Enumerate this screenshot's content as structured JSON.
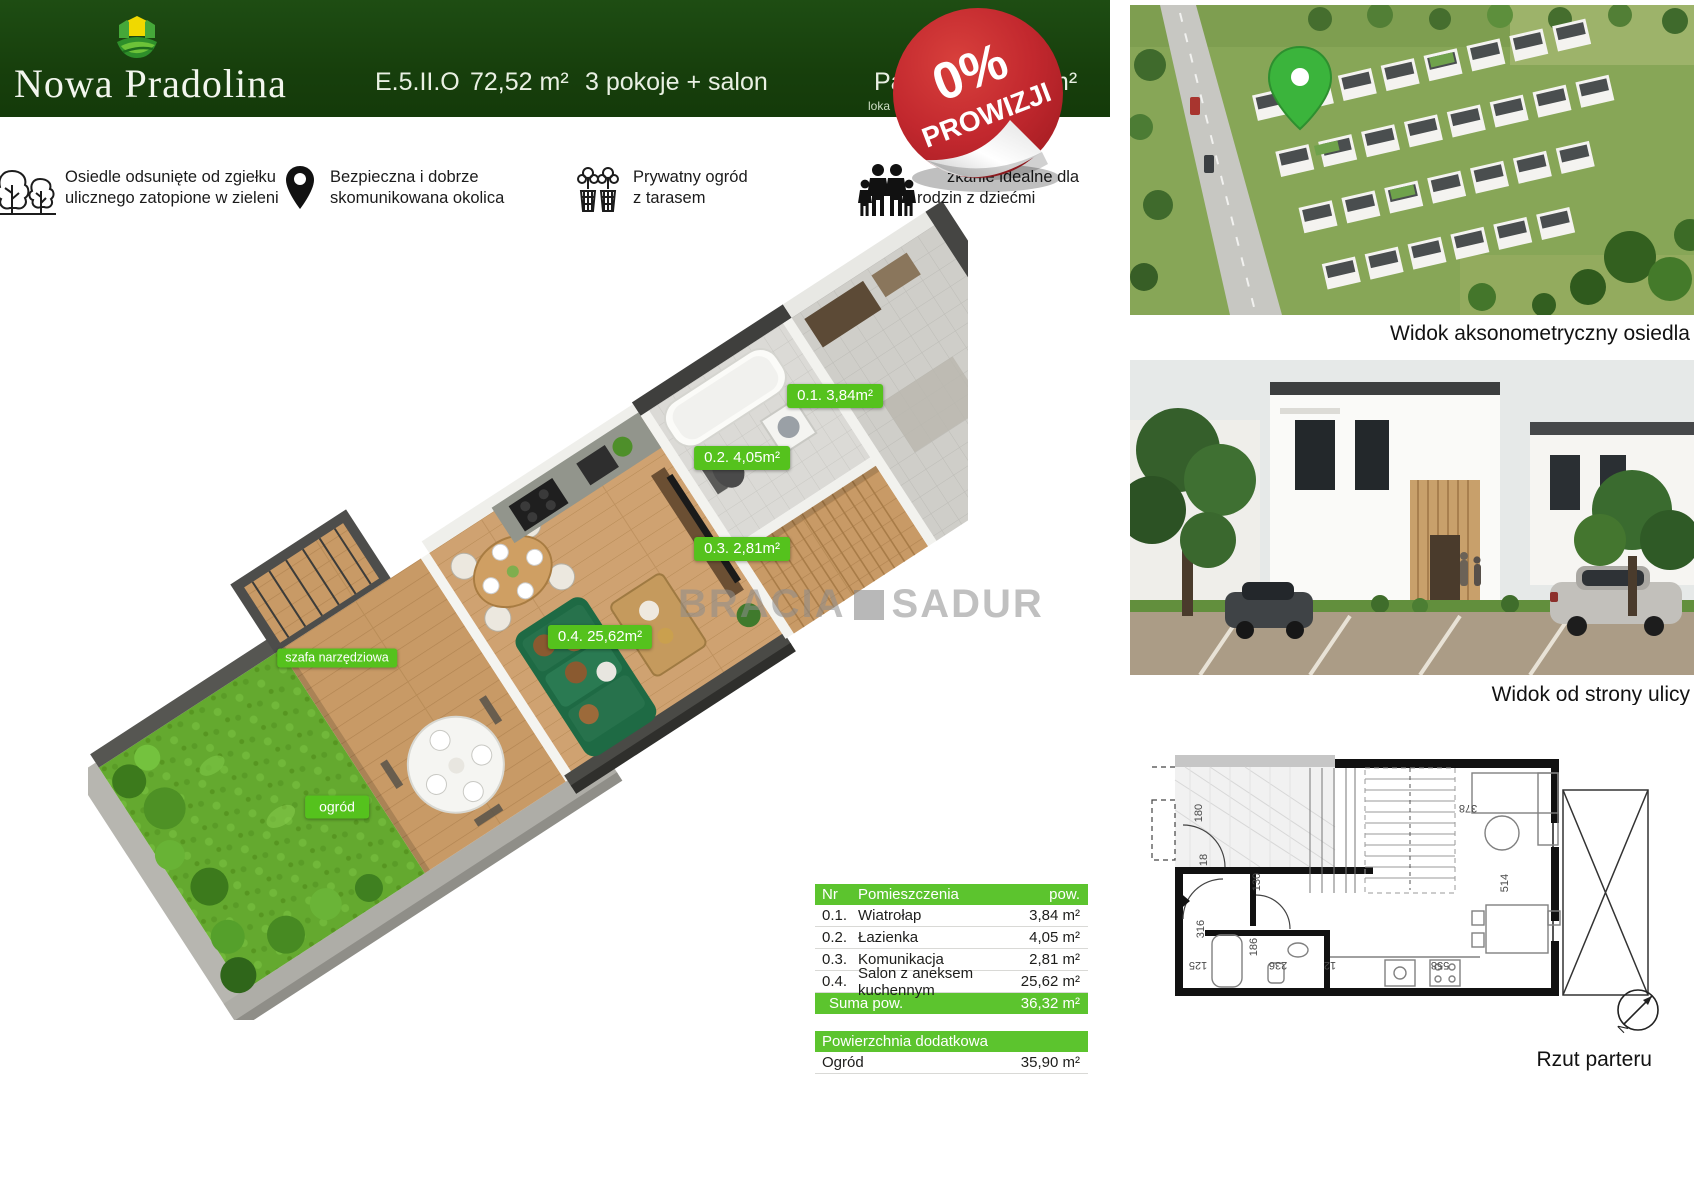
{
  "header": {
    "title": "Nowa Pradolina",
    "unit_code": "E.5.II.O",
    "unit_area": "72,52 m²",
    "unit_rooms": "3 pokoje + salon",
    "truncated_label": "Pa",
    "truncated_small": "loka",
    "truncated_area": "m²"
  },
  "badge": {
    "percent": "0%",
    "word": "PROWIZJI"
  },
  "features": [
    {
      "icon": "trees-icon",
      "line1": "Osiedle odsunięte od zgiełku",
      "line2": "ulicznego zatopione w zieleni"
    },
    {
      "icon": "map-pin-icon",
      "line1": "Bezpieczna i dobrze",
      "line2": "skomunikowana okolica"
    },
    {
      "icon": "garden-plants-icon",
      "line1": "Prywatny ogród",
      "line2": "z tarasem"
    },
    {
      "icon": "family-icon",
      "line1": "zkanie idealne dla",
      "line2": "rodzin z dziećmi"
    }
  ],
  "plan3d": {
    "labels": {
      "room1": "0.1. 3,84m²",
      "room2": "0.2. 4,05m²",
      "room3": "0.3. 2,81m²",
      "room4": "0.4. 25,62m²",
      "shed": "szafa narzędziowa",
      "garden": "ogród"
    },
    "watermark_left": "BRACIA",
    "watermark_right": "SADUR"
  },
  "tables": {
    "rooms": {
      "header": {
        "nr": "Nr",
        "name": "Pomieszczenia",
        "area": "pow."
      },
      "rows": [
        {
          "nr": "0.1.",
          "name": "Wiatrołap",
          "area": "3,84 m²"
        },
        {
          "nr": "0.2.",
          "name": "Łazienka",
          "area": "4,05 m²"
        },
        {
          "nr": "0.3.",
          "name": "Komunikacja",
          "area": "2,81 m²"
        },
        {
          "nr": "0.4.",
          "name": "Salon z aneksem kuchennym",
          "area": "25,62 m²"
        }
      ],
      "footer": {
        "label": "Suma pow.",
        "area": "36,32 m²"
      }
    },
    "extra": {
      "header": "Powierzchnia dodatkowa",
      "row": {
        "name": "Ogród",
        "area": "35,90 m²"
      }
    }
  },
  "captions": {
    "aerial": "Widok aksonometryczny osiedla",
    "street": "Widok od strony ulicy",
    "plan": "Rzut parteru"
  },
  "rzut": {
    "dims": [
      "180",
      "18",
      "130",
      "316",
      "186",
      "125",
      "236",
      "12",
      "378",
      "514",
      "558"
    ],
    "compass": "N"
  },
  "colors": {
    "header_green": "#1b4410",
    "tag_green": "#55c21d",
    "table_green": "#5cc42e",
    "badge_red": "#c2282e"
  }
}
